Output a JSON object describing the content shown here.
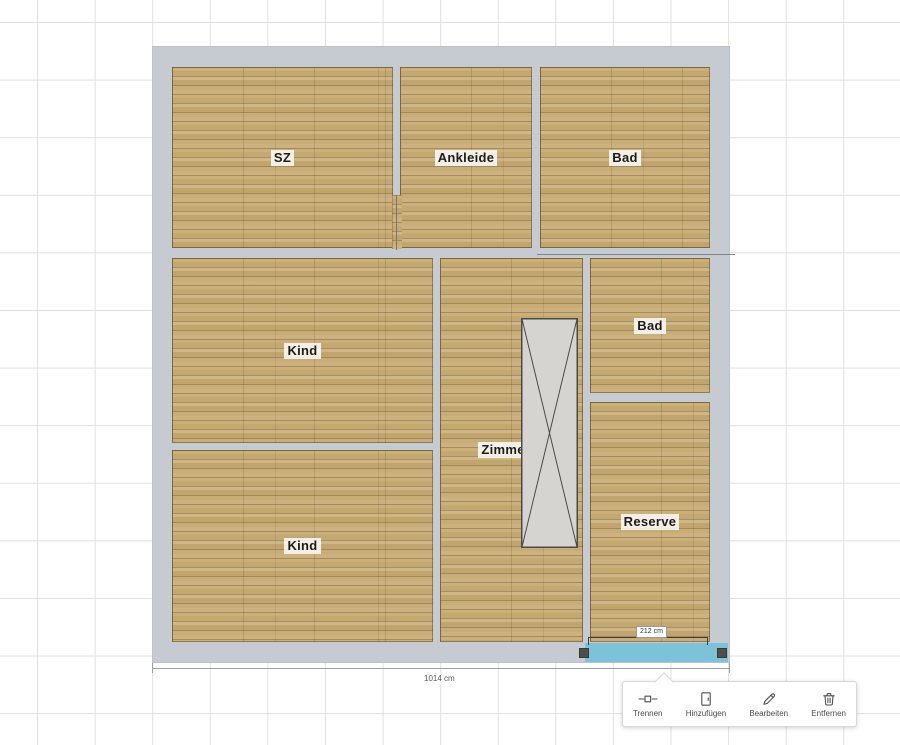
{
  "floorplan": {
    "rooms": [
      {
        "id": "sz",
        "label": "SZ"
      },
      {
        "id": "ankleide",
        "label": "Ankleide"
      },
      {
        "id": "bad-top",
        "label": "Bad"
      },
      {
        "id": "kind-middle",
        "label": "Kind"
      },
      {
        "id": "kind-bottom",
        "label": "Kind"
      },
      {
        "id": "zimmer-3",
        "label": "Zimmer 3"
      },
      {
        "id": "bad-middle",
        "label": "Bad"
      },
      {
        "id": "reserve",
        "label": "Reserve"
      }
    ],
    "objects": [
      {
        "id": "staircase",
        "type": "stairs-with-cross"
      }
    ],
    "selected_wall": {
      "length_label": "212 cm",
      "highlight_color": "#7dc2d8"
    },
    "outer_width_label": "1014 cm",
    "colors": {
      "wall": "#c6cbd2",
      "floor_base": "#c7ad77",
      "stair_fill": "#d5d4d1",
      "selection": "#7dc2d8"
    }
  },
  "toolbar": {
    "items": [
      {
        "label": "Trennen",
        "icon": "split-wall-icon"
      },
      {
        "label": "Hinzufügen",
        "icon": "add-door-icon"
      },
      {
        "label": "Bearbeiten",
        "icon": "edit-pencil-icon"
      },
      {
        "label": "Entfernen",
        "icon": "delete-trash-icon"
      }
    ]
  }
}
